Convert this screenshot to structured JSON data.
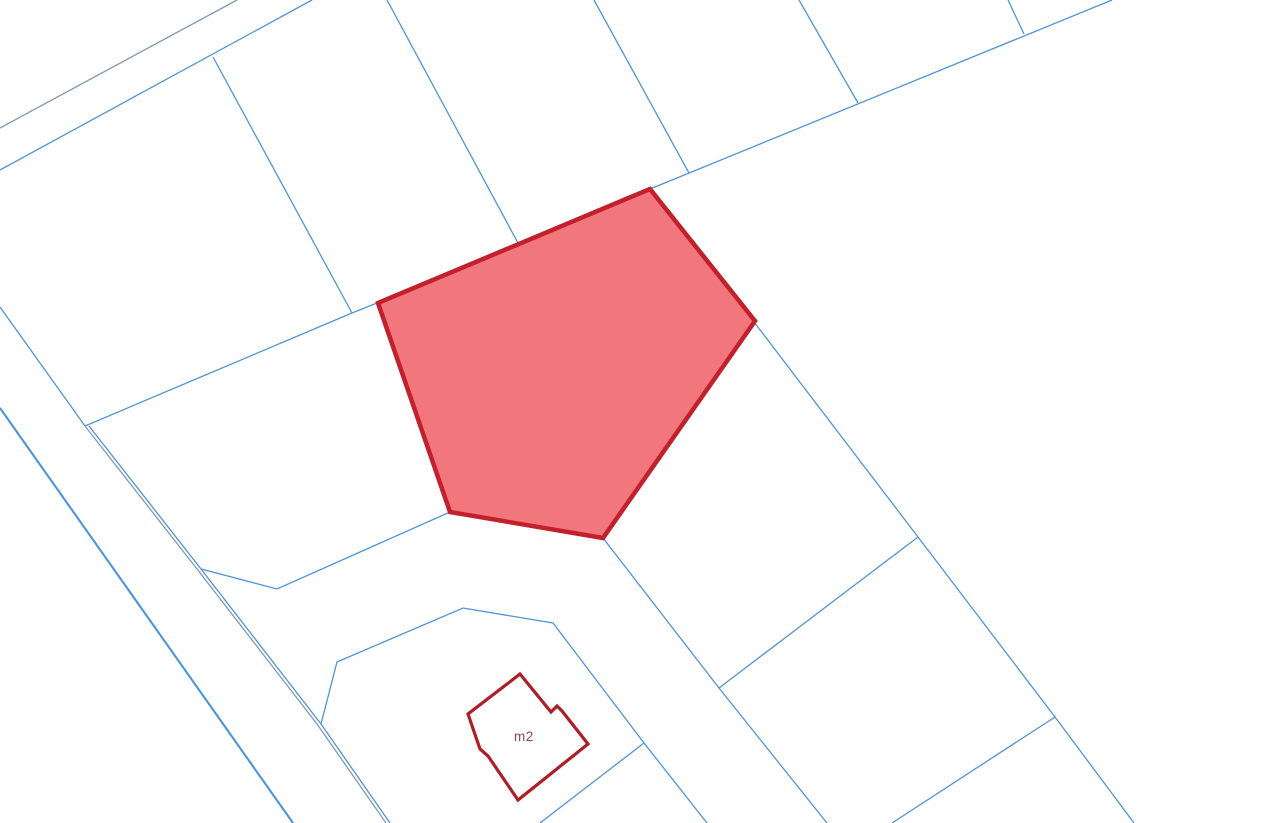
{
  "map": {
    "canvas": {
      "width": 1276,
      "height": 823,
      "background": "#ffffff"
    },
    "colors": {
      "boundary_bright": "#4f94d8",
      "boundary_muted": "#7e98b4",
      "parcel_stroke": "#c2202c",
      "parcel_fill": "#f2777d",
      "building_stroke": "#ae1e26",
      "label_color": "#9d4046"
    },
    "boundary_lines": [
      {
        "name": "road-edge-upper-left-outer",
        "tone": "muted",
        "width": 1.3,
        "points": [
          [
            237,
            0
          ],
          [
            0,
            128
          ]
        ]
      },
      {
        "name": "road-edge-upper-left-inner",
        "tone": "bright",
        "width": 1.3,
        "points": [
          [
            312,
            0
          ],
          [
            0,
            170
          ]
        ]
      },
      {
        "name": "parcel-boundary-nw-steep",
        "tone": "bright",
        "width": 1.3,
        "points": [
          [
            213,
            57
          ],
          [
            352,
            313
          ]
        ]
      },
      {
        "name": "parcel-boundary-left-upper",
        "tone": "bright",
        "width": 1.3,
        "points": [
          [
            0,
            307
          ],
          [
            85,
            426
          ]
        ]
      },
      {
        "name": "parcel-boundary-to-parcel-corner",
        "tone": "bright",
        "width": 1.3,
        "points": [
          [
            85,
            426
          ],
          [
            352,
            313
          ],
          [
            377,
            303
          ]
        ]
      },
      {
        "name": "road-edge-far-left",
        "tone": "bright",
        "width": 2.1,
        "points": [
          [
            0,
            408
          ],
          [
            293,
            823
          ]
        ]
      },
      {
        "name": "road-pair-west-line",
        "tone": "muted",
        "width": 1.3,
        "points": [
          [
            85,
            426
          ],
          [
            197,
            569
          ],
          [
            317,
            724
          ],
          [
            386,
            823
          ]
        ]
      },
      {
        "name": "road-pair-east-line",
        "tone": "bright",
        "width": 1.3,
        "points": [
          [
            89,
            426
          ],
          [
            201,
            569
          ],
          [
            321,
            724
          ],
          [
            390,
            823
          ]
        ]
      },
      {
        "name": "boundary-road-to-parcel-sw-corner",
        "tone": "bright",
        "width": 1.3,
        "points": [
          [
            201,
            569
          ],
          [
            277,
            589
          ],
          [
            450,
            512
          ]
        ]
      },
      {
        "name": "parcel-boundary-top-a",
        "tone": "bright",
        "width": 1.3,
        "points": [
          [
            387,
            0
          ],
          [
            518,
            243
          ]
        ]
      },
      {
        "name": "parcel-boundary-top-b",
        "tone": "bright",
        "width": 1.3,
        "points": [
          [
            594,
            0
          ],
          [
            689,
            173
          ]
        ]
      },
      {
        "name": "parcel-boundary-long-ne",
        "tone": "bright",
        "width": 1.3,
        "points": [
          [
            1112,
            0
          ],
          [
            650,
            189
          ]
        ]
      },
      {
        "name": "parcel-boundary-top-c",
        "tone": "bright",
        "width": 1.3,
        "points": [
          [
            799,
            0
          ],
          [
            858,
            103
          ]
        ]
      },
      {
        "name": "parcel-boundary-top-d",
        "tone": "bright",
        "width": 1.3,
        "points": [
          [
            1008,
            0
          ],
          [
            1024,
            34
          ]
        ]
      },
      {
        "name": "boundary-from-parcel-east-corner",
        "tone": "bright",
        "width": 1.3,
        "points": [
          [
            754,
            322
          ],
          [
            918,
            537
          ]
        ]
      },
      {
        "name": "boundary-east-descending",
        "tone": "bright",
        "width": 1.3,
        "points": [
          [
            918,
            537
          ],
          [
            1055,
            717
          ],
          [
            1134,
            823
          ]
        ]
      },
      {
        "name": "boundary-east-branch-sw",
        "tone": "bright",
        "width": 1.3,
        "points": [
          [
            1055,
            717
          ],
          [
            892,
            823
          ]
        ]
      },
      {
        "name": "boundary-junction-cross",
        "tone": "bright",
        "width": 1.3,
        "points": [
          [
            918,
            537
          ],
          [
            719,
            688
          ]
        ]
      },
      {
        "name": "boundary-from-parcel-south-vertex",
        "tone": "bright",
        "width": 1.3,
        "points": [
          [
            603,
            538
          ],
          [
            719,
            688
          ],
          [
            827,
            823
          ]
        ]
      },
      {
        "name": "building-parcel-boundary",
        "tone": "bright",
        "width": 1.3,
        "points": [
          [
            321,
            724
          ],
          [
            337,
            662
          ],
          [
            463,
            608
          ],
          [
            553,
            623
          ],
          [
            644,
            743
          ],
          [
            707,
            823
          ]
        ]
      },
      {
        "name": "building-parcel-branch-sw",
        "tone": "bright",
        "width": 1.3,
        "points": [
          [
            644,
            743
          ],
          [
            540,
            823
          ]
        ]
      }
    ],
    "selected_parcel": {
      "stroke_width": 4.5,
      "points": [
        [
          650,
          189
        ],
        [
          755,
          321
        ],
        [
          603,
          538
        ],
        [
          450,
          512
        ],
        [
          378,
          303
        ]
      ]
    },
    "building": {
      "stroke_width": 3.2,
      "points": [
        [
          520,
          674
        ],
        [
          551,
          712
        ],
        [
          557,
          706
        ],
        [
          562,
          711
        ],
        [
          588,
          744
        ],
        [
          518,
          800
        ],
        [
          488,
          756
        ],
        [
          480,
          749
        ],
        [
          468,
          714
        ]
      ],
      "label": "m2",
      "label_x": 514,
      "label_y": 741
    }
  }
}
